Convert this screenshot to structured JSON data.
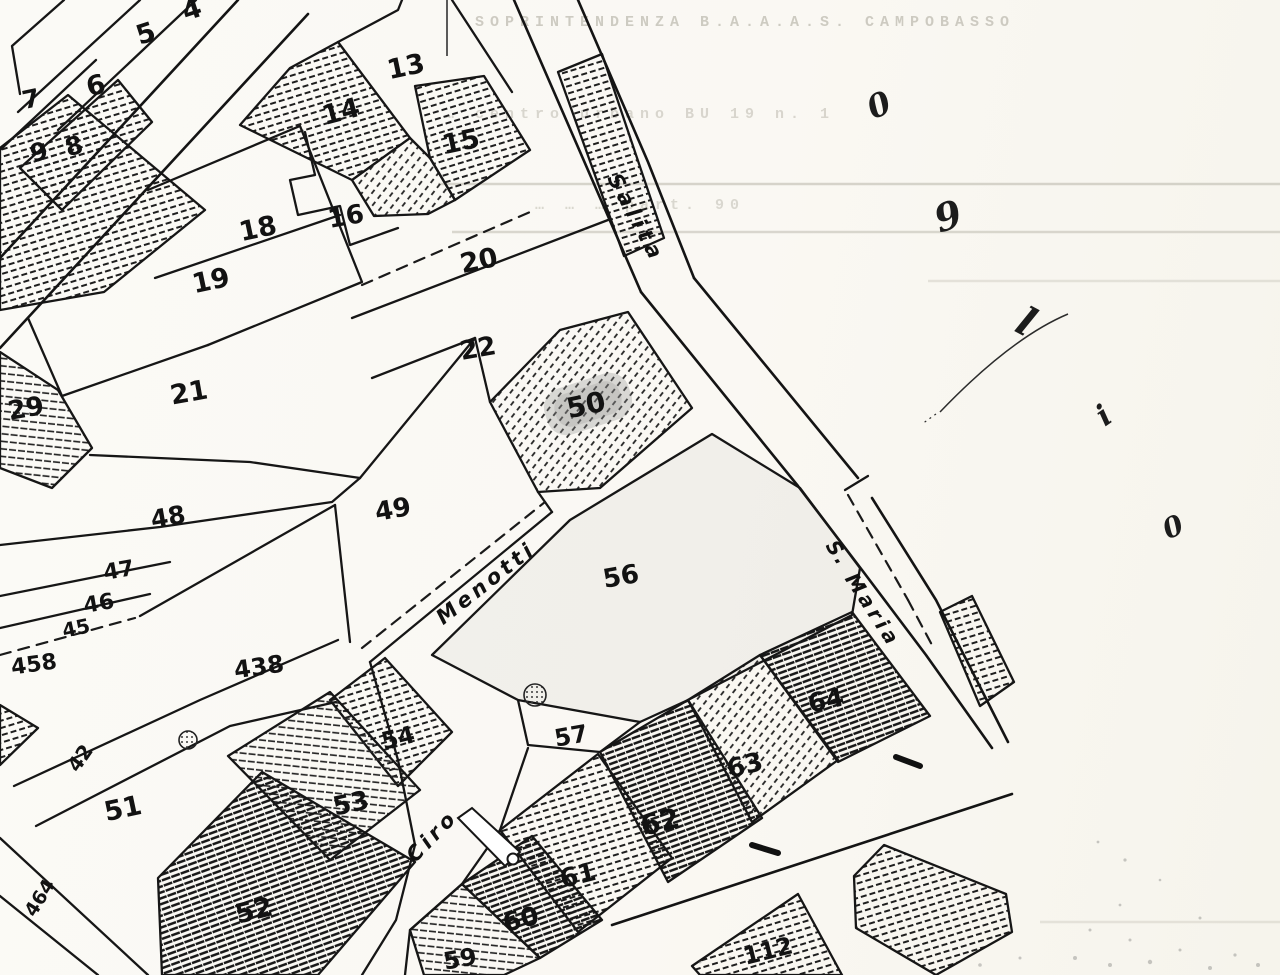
{
  "page": {
    "width": 1280,
    "height": 975,
    "paper_color": "#faf8f3",
    "ink_color": "#1a1a1a",
    "description": "Scanned cadastral map sheet over faint typewritten document"
  },
  "underlay": {
    "typewritten_lines": [
      {
        "text": "SOPRINTENDENZA  B.A.A.A.S.   CAMPOBASSO",
        "x": 745,
        "y": 14,
        "size": 15,
        "opacity": 0.55
      },
      {
        "text": "… centro urbano  BU 19 n. 1",
        "x": 640,
        "y": 106,
        "size": 15,
        "opacity": 0.42
      },
      {
        "text": "… … …  part. 90",
        "x": 640,
        "y": 197,
        "size": 15,
        "opacity": 0.4
      }
    ],
    "rule_lines": [
      {
        "x1": 438,
        "y": 184,
        "x2": 1280,
        "opacity": 0.55
      },
      {
        "x1": 452,
        "y": 232,
        "x2": 1280,
        "opacity": 0.5
      },
      {
        "x1": 928,
        "y": 281,
        "x2": 1280,
        "opacity": 0.32
      },
      {
        "x1": 1040,
        "y": 922,
        "x2": 1280,
        "opacity": 0.3
      }
    ]
  },
  "map": {
    "streets": [
      {
        "name": "Salita",
        "x": 636,
        "y": 218,
        "rotation": 62,
        "size": 21,
        "spacing": 5
      },
      {
        "name": "S.",
        "x": 838,
        "y": 553,
        "rotation": 57,
        "size": 20,
        "spacing": 2
      },
      {
        "name": "Maria",
        "x": 873,
        "y": 610,
        "rotation": 57,
        "size": 20,
        "spacing": 4
      },
      {
        "name": "Menotti",
        "x": 486,
        "y": 583,
        "rotation": -38,
        "size": 21,
        "spacing": 4
      },
      {
        "name": "Ciro",
        "x": 432,
        "y": 836,
        "rotation": -46,
        "size": 21,
        "spacing": 4
      }
    ],
    "parcels": [
      {
        "n": "4",
        "x": 192,
        "y": 10,
        "r": -18,
        "size": 27
      },
      {
        "n": "5",
        "x": 146,
        "y": 34,
        "r": -18,
        "size": 27
      },
      {
        "n": "6",
        "x": 96,
        "y": 86,
        "r": -14,
        "size": 27
      },
      {
        "n": "7",
        "x": 31,
        "y": 99,
        "r": -12,
        "size": 25
      },
      {
        "n": "8",
        "x": 74,
        "y": 146,
        "r": -15,
        "size": 25
      },
      {
        "n": "9",
        "x": 39,
        "y": 152,
        "r": -15,
        "size": 25
      },
      {
        "n": "13",
        "x": 406,
        "y": 67,
        "r": -12,
        "size": 27
      },
      {
        "n": "14",
        "x": 341,
        "y": 112,
        "r": -15,
        "size": 27
      },
      {
        "n": "15",
        "x": 461,
        "y": 142,
        "r": -12,
        "size": 27
      },
      {
        "n": "16",
        "x": 346,
        "y": 217,
        "r": -10,
        "size": 26
      },
      {
        "n": "18",
        "x": 258,
        "y": 229,
        "r": -12,
        "size": 27
      },
      {
        "n": "19",
        "x": 211,
        "y": 281,
        "r": -12,
        "size": 27
      },
      {
        "n": "20",
        "x": 479,
        "y": 261,
        "r": -12,
        "size": 27
      },
      {
        "n": "21",
        "x": 189,
        "y": 393,
        "r": -10,
        "size": 27
      },
      {
        "n": "22",
        "x": 478,
        "y": 349,
        "r": -10,
        "size": 26
      },
      {
        "n": "29",
        "x": 26,
        "y": 409,
        "r": -10,
        "size": 26
      },
      {
        "n": "48",
        "x": 168,
        "y": 517,
        "r": -10,
        "size": 25
      },
      {
        "n": "49",
        "x": 393,
        "y": 510,
        "r": -10,
        "size": 26
      },
      {
        "n": "50",
        "x": 586,
        "y": 405,
        "r": -12,
        "size": 28
      },
      {
        "n": "47",
        "x": 119,
        "y": 571,
        "r": -10,
        "size": 22
      },
      {
        "n": "46",
        "x": 99,
        "y": 604,
        "r": -10,
        "size": 22
      },
      {
        "n": "45",
        "x": 76,
        "y": 628,
        "r": -12,
        "size": 20
      },
      {
        "n": "458",
        "x": 34,
        "y": 665,
        "r": -8,
        "size": 22
      },
      {
        "n": "438",
        "x": 259,
        "y": 667,
        "r": -8,
        "size": 24
      },
      {
        "n": "56",
        "x": 621,
        "y": 577,
        "r": -10,
        "size": 26
      },
      {
        "n": "42",
        "x": 80,
        "y": 758,
        "r": -55,
        "size": 20
      },
      {
        "n": "51",
        "x": 123,
        "y": 809,
        "r": -12,
        "size": 27
      },
      {
        "n": "52",
        "x": 254,
        "y": 911,
        "r": -14,
        "size": 27
      },
      {
        "n": "53",
        "x": 351,
        "y": 804,
        "r": -12,
        "size": 26
      },
      {
        "n": "54",
        "x": 398,
        "y": 738,
        "r": -14,
        "size": 24
      },
      {
        "n": "57",
        "x": 571,
        "y": 736,
        "r": -10,
        "size": 24
      },
      {
        "n": "464",
        "x": 40,
        "y": 898,
        "r": -58,
        "size": 19
      },
      {
        "n": "59",
        "x": 460,
        "y": 959,
        "r": -10,
        "size": 24
      },
      {
        "n": "60",
        "x": 521,
        "y": 920,
        "r": -14,
        "size": 26
      },
      {
        "n": "61",
        "x": 578,
        "y": 876,
        "r": -14,
        "size": 26
      },
      {
        "n": "62",
        "x": 660,
        "y": 822,
        "r": -14,
        "size": 28
      },
      {
        "n": "63",
        "x": 745,
        "y": 766,
        "r": -14,
        "size": 26
      },
      {
        "n": "64",
        "x": 826,
        "y": 701,
        "r": -12,
        "size": 26
      },
      {
        "n": "112",
        "x": 768,
        "y": 951,
        "r": -14,
        "size": 24
      }
    ]
  },
  "annotations": {
    "marks": [
      {
        "glyph": "0",
        "x": 879,
        "y": 105,
        "rotation": -24,
        "size": 32
      },
      {
        "glyph": "9",
        "x": 948,
        "y": 216,
        "rotation": -18,
        "size": 38
      },
      {
        "glyph": "l",
        "x": 1026,
        "y": 322,
        "rotation": 28,
        "size": 40
      },
      {
        "glyph": "i",
        "x": 1104,
        "y": 416,
        "rotation": -35,
        "size": 30
      },
      {
        "glyph": "0",
        "x": 1173,
        "y": 527,
        "rotation": -24,
        "size": 28
      }
    ]
  }
}
